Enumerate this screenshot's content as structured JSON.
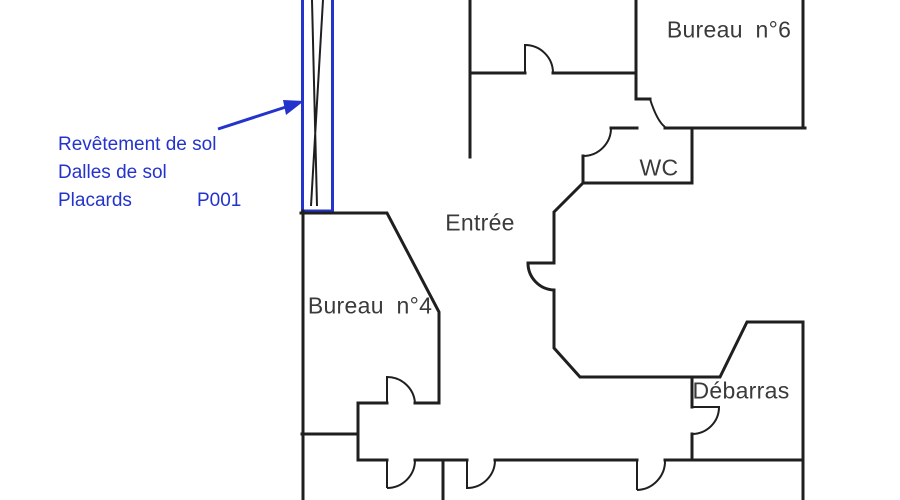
{
  "plan": {
    "title": "Floor plan",
    "rooms": [
      {
        "id": "bureau6",
        "label": "Bureau n°6"
      },
      {
        "id": "wc",
        "label": "WC"
      },
      {
        "id": "entree",
        "label": "Entrée"
      },
      {
        "id": "bureau4",
        "label": "Bureau n°4"
      },
      {
        "id": "debarras",
        "label": "Débarras"
      }
    ],
    "annotation": {
      "lines": [
        "Revêtement de sol",
        "Dalles de sol",
        "Placards"
      ],
      "code": "P001"
    },
    "colors": {
      "wall": "#1f1f1f",
      "highlight": "#2433cb",
      "label": "#3a3a3a",
      "hatch": "#71717a",
      "background": "#ffffff"
    }
  }
}
